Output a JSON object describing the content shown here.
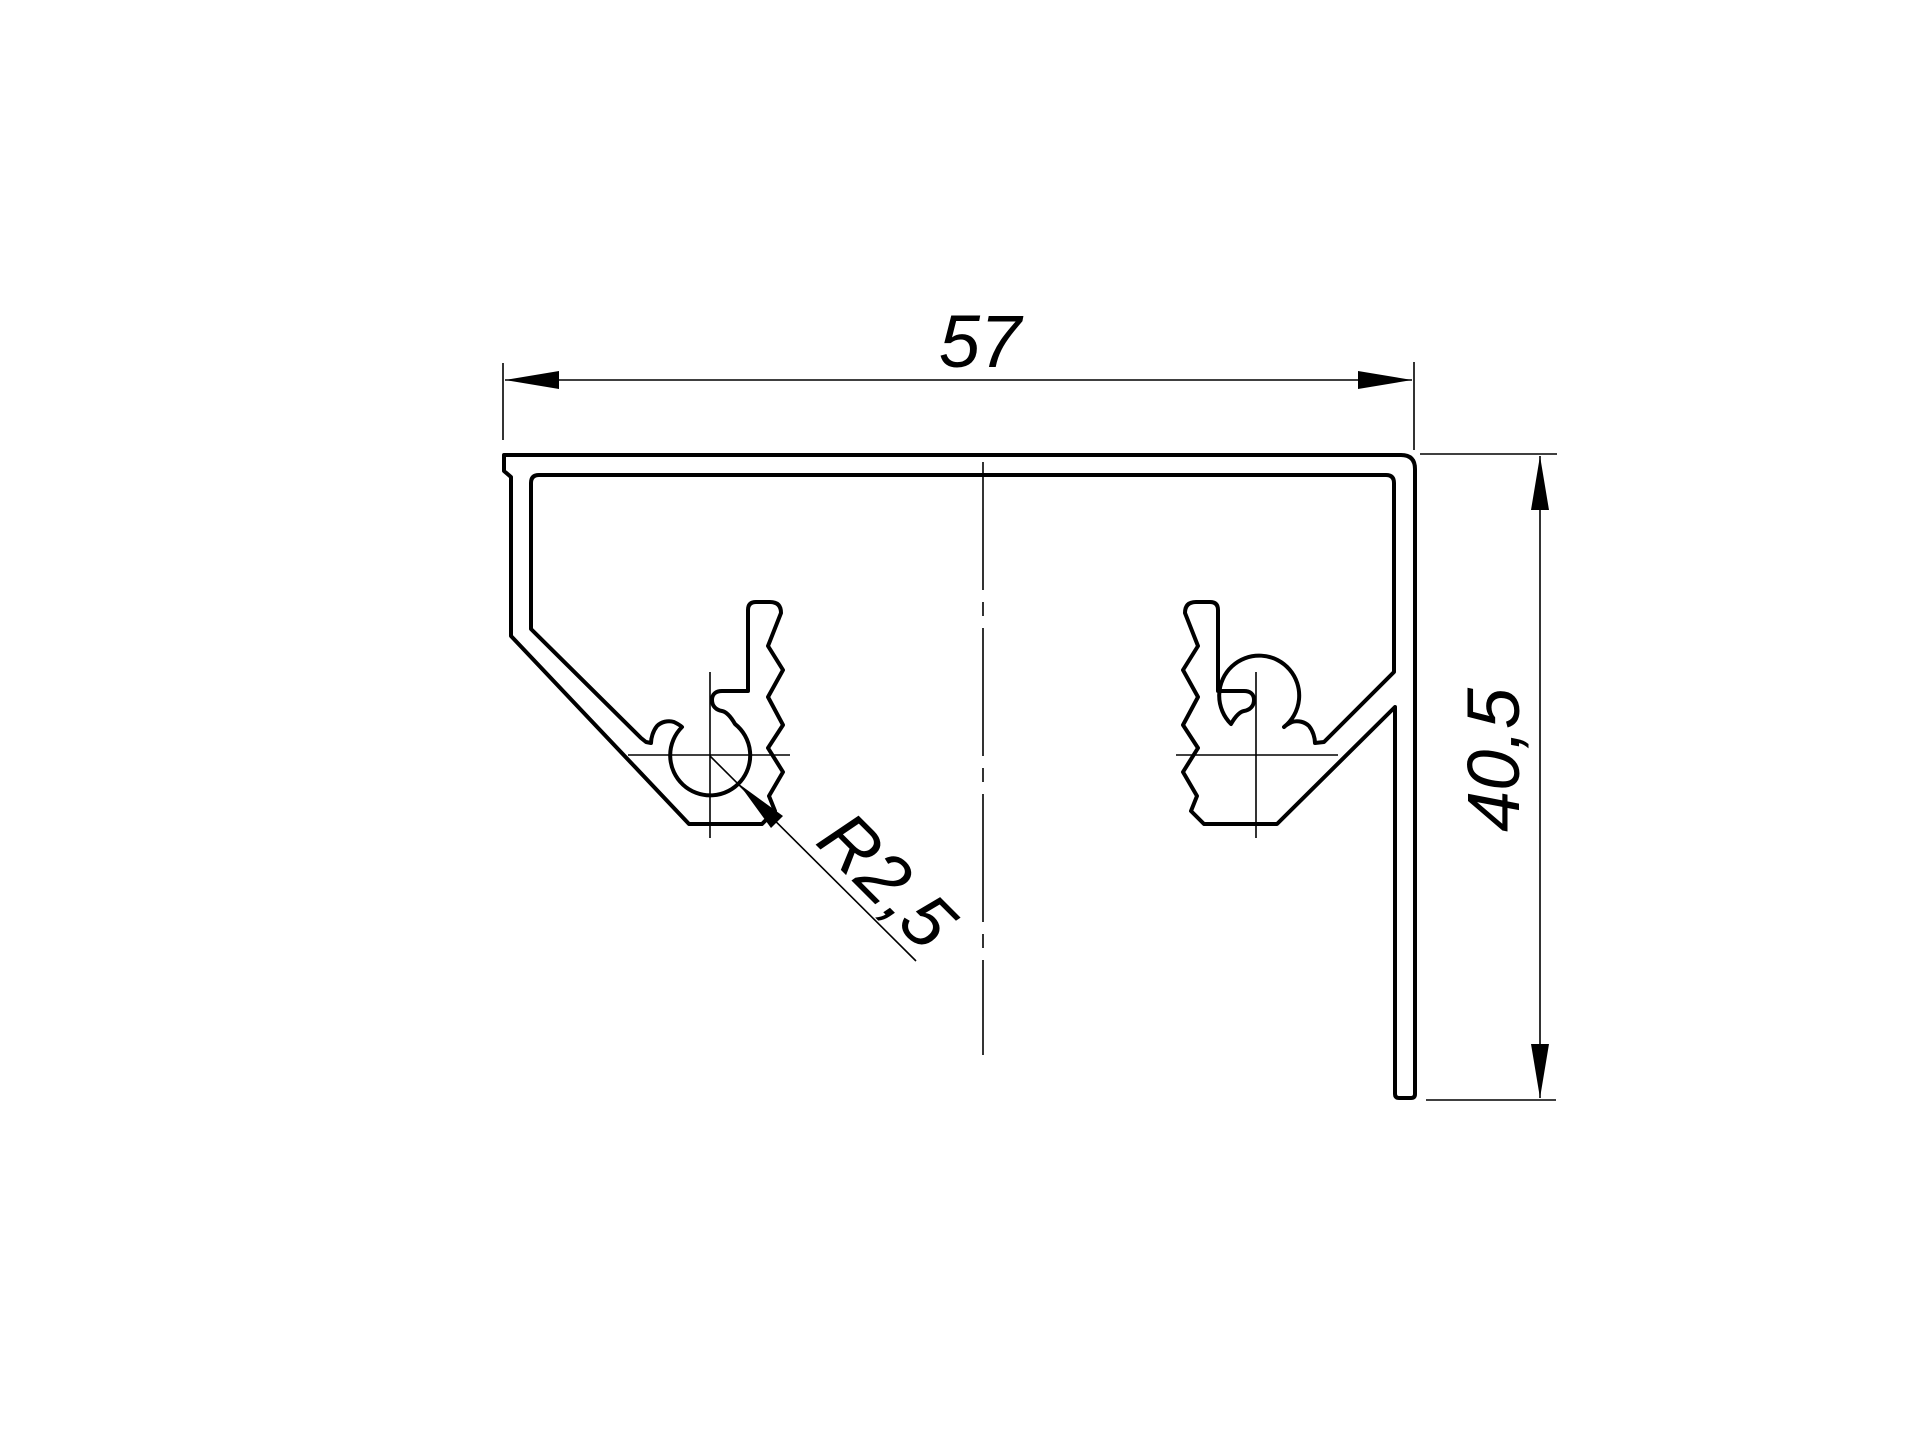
{
  "drawing": {
    "background_color": "#ffffff",
    "line_color": "#000000",
    "dimensions": {
      "width": "57",
      "height": "40,5",
      "radius": "R2,5"
    }
  }
}
